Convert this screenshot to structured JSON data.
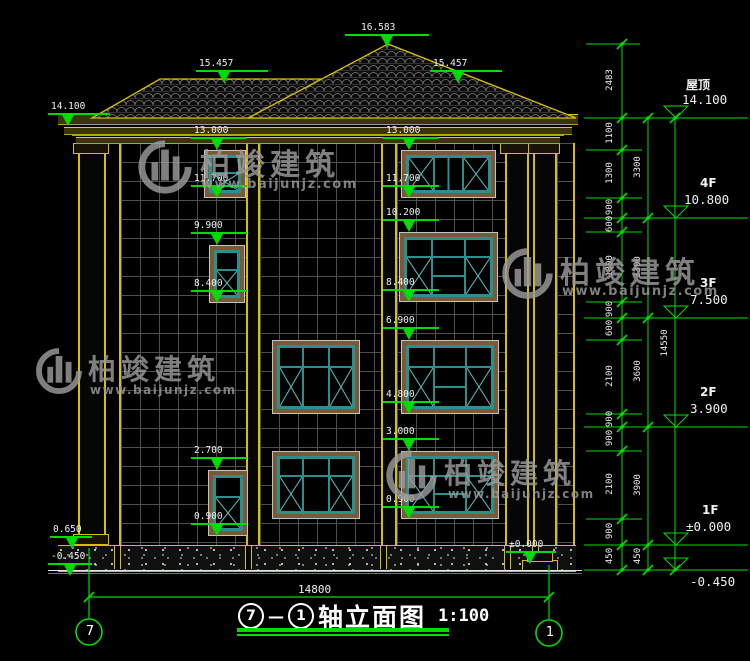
{
  "watermark": {
    "brand": "柏竣建筑",
    "site": "www.baijunjz.com"
  },
  "roof_markers": {
    "peak": "16.583",
    "left_ridge": "15.457",
    "right_ridge": "15.457",
    "eave": "14.100"
  },
  "left_col_markers": [
    "13.000",
    "11.700",
    "9.900",
    "8.400",
    "2.700",
    "0.900"
  ],
  "mid_col_markers": [
    "13.000",
    "11.700",
    "10.200",
    "8.400",
    "6.900",
    "4.800",
    "3.000",
    "0.900"
  ],
  "site_markers": {
    "plinth": "0.650",
    "ground_left": "-0.450",
    "entry": "±0.000"
  },
  "right_levels": [
    {
      "label": "屋顶",
      "value": "14.100"
    },
    {
      "label": "4F",
      "value": "10.800"
    },
    {
      "label": "3F",
      "value": "7.500"
    },
    {
      "label": "2F",
      "value": "3.900"
    },
    {
      "label": "1F",
      "value": "±0.000"
    },
    {
      "label": "",
      "value": "-0.450"
    }
  ],
  "dim_inner": [
    "2483",
    "1100",
    "1300",
    "900",
    "600",
    "1800",
    "900",
    "600",
    "2100",
    "900",
    "900",
    "2100",
    "900",
    "450"
  ],
  "dim_mid": [
    "3300",
    "3300",
    "3600",
    "3900",
    "450"
  ],
  "dim_overall": "14550",
  "dim_width": "14800",
  "axis_bubbles": {
    "left": "7",
    "right": "1"
  },
  "title": {
    "from": "7",
    "dash": "—",
    "to": "1",
    "name": "轴立面图",
    "scale": "1:100"
  },
  "colors": {
    "dim_green": "#00dc00",
    "line_yellow": "#d8c000",
    "frame_teal": "#2a8f8f",
    "surround_brown": "#7a5a35",
    "text_white": "#f0f0f0",
    "watermark_gray": "#9b9b9b"
  }
}
